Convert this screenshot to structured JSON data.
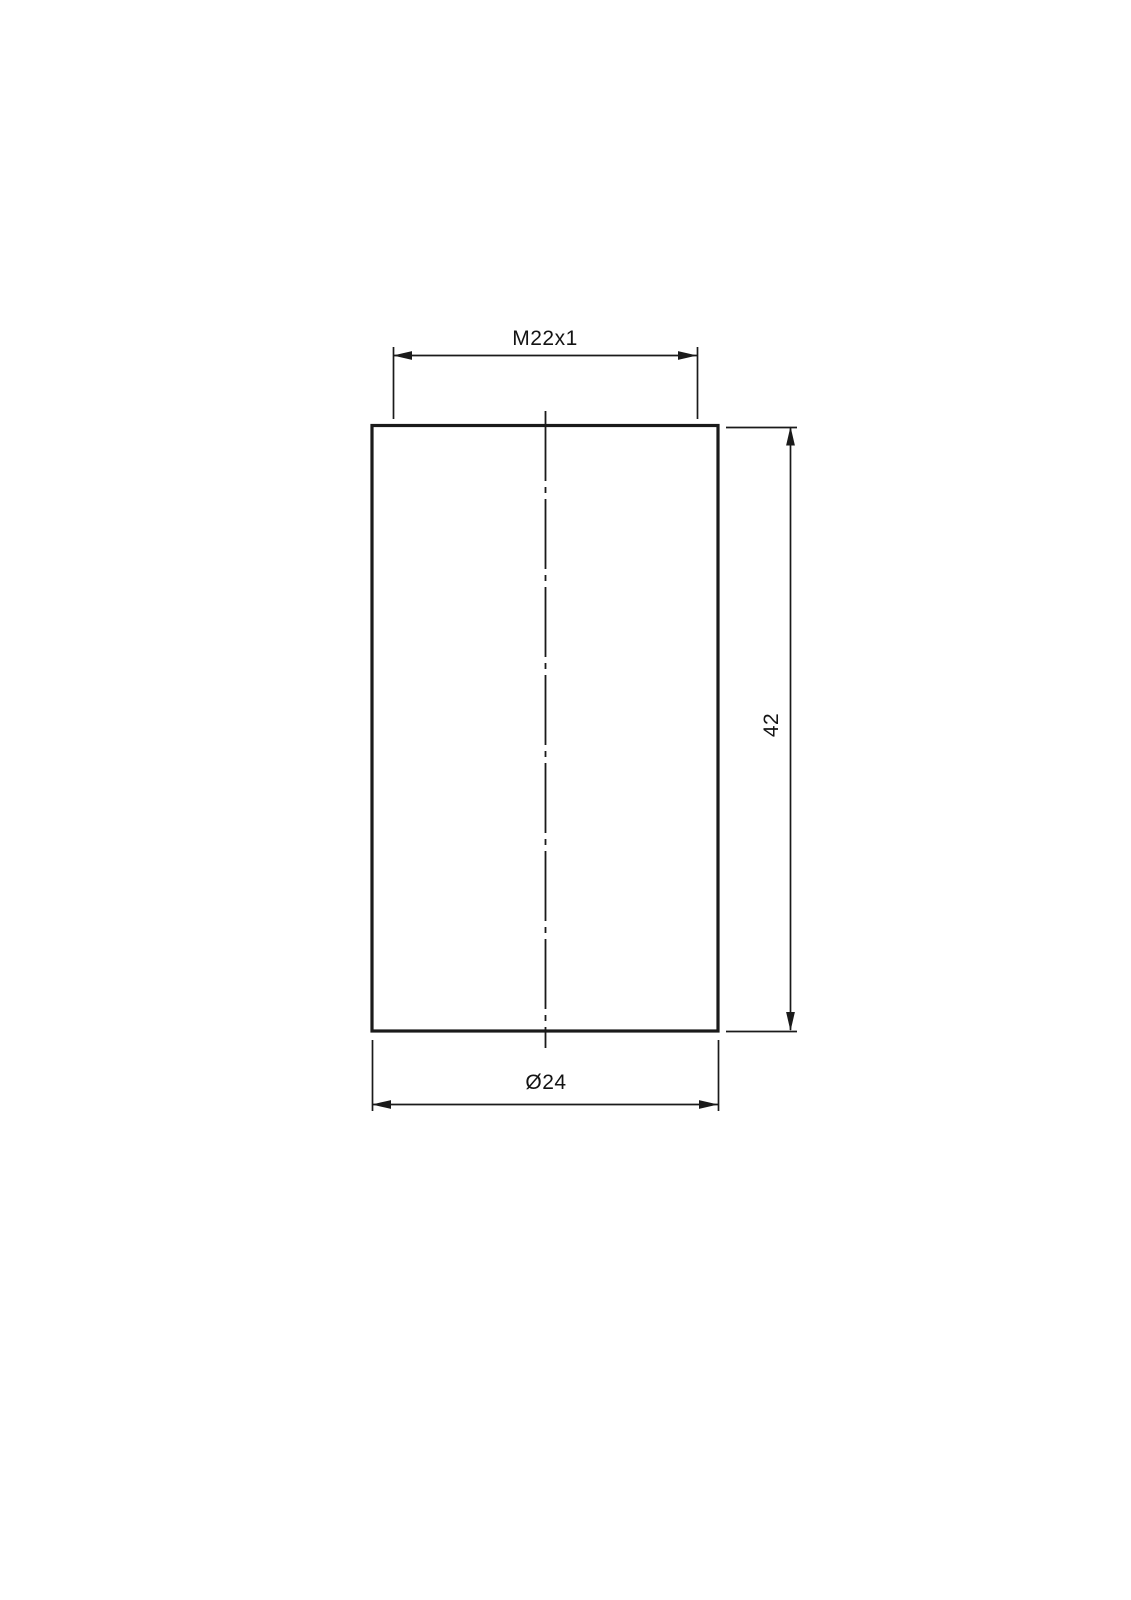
{
  "drawing": {
    "labels": {
      "thread": "M22x1",
      "height": "42",
      "diameter": "Ø24"
    },
    "colors": {
      "line": "#1a1a1a",
      "background": "#ffffff"
    }
  }
}
